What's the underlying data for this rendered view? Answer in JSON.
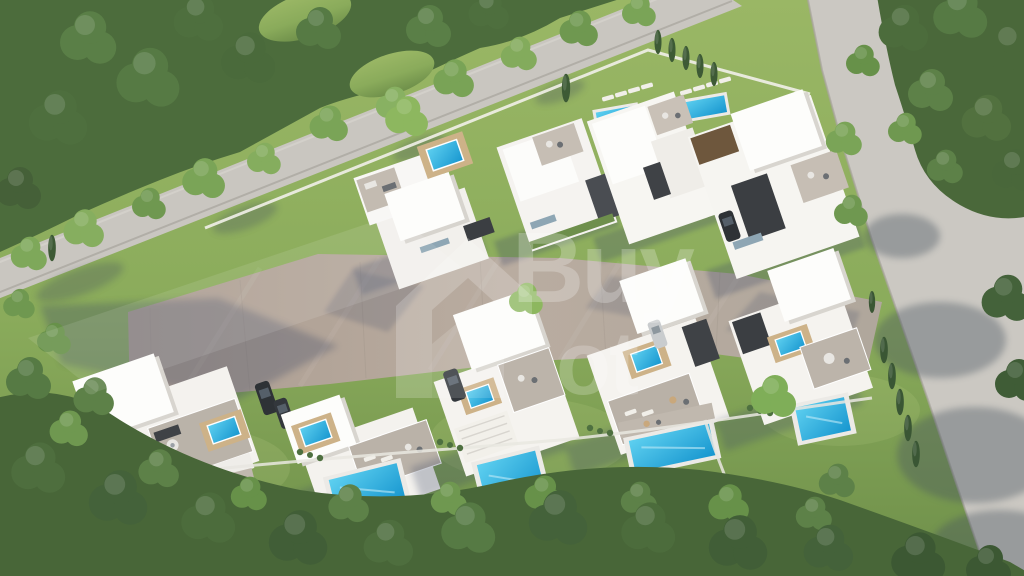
{
  "meta": {
    "type": "3d-architectural-aerial-render",
    "subject": "Aerial view of a modern white villa development with private pools, paved driveway, two roads and dense surrounding trees"
  },
  "watermark": {
    "line1": "Buy",
    "line2": "ot",
    "partial": true,
    "color": "#ffffff",
    "opacity": 0.22
  },
  "scene": {
    "back_row_villas": 4,
    "front_row_villas": 5,
    "garden_pools": 5,
    "rooftop_pools": 7,
    "lap_pools": 2,
    "cars": 4,
    "roads": 2
  },
  "palette": {
    "grass_light": "#9ab765",
    "grass_dark": "#6e8f4a",
    "forest_dark": "#44623a",
    "forest_mid": "#567a44",
    "forest_light": "#7aa457",
    "road": "#c9c6c0",
    "paving": "#b3a79b",
    "villa_wall": "#f5f3ef",
    "roof": "#fdfdfb",
    "terrace": "#bab2a8",
    "wood_deck": "#cdb288",
    "charcoal": "#3b3e42",
    "pool_light": "#5ed0f0",
    "pool_deep": "#1796cf",
    "shadow": "#3c4a66"
  }
}
